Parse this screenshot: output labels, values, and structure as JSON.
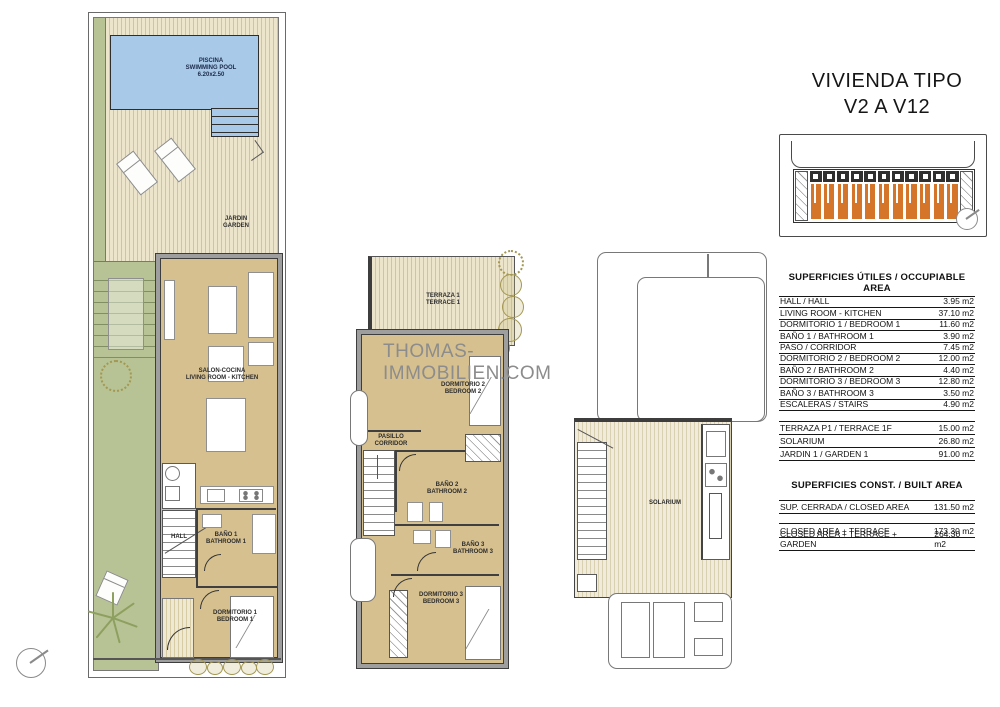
{
  "watermark": "THOMAS-IMMOBILIEN.COM",
  "title": {
    "line1": "VIVIENDA TIPO",
    "line2": "V2 A V12"
  },
  "plans": {
    "ground": {
      "pool_label": "PISCINA\nSWIMMING POOL\n6.20x2.50",
      "garden_label": "JARDIN\nGARDEN",
      "living_label": "SALON-COCINA\nLIVING ROOM - KITCHEN",
      "hall_label": "HALL",
      "bath1_label": "BAÑO 1\nBATHROOM 1",
      "bed1_label": "DORMITORIO 1\nBEDROOM 1"
    },
    "first": {
      "terrace_label": "TERRAZA 1\nTERRACE 1",
      "bed2_label": "DORMITORIO 2\nBEDROOM 2",
      "corridor_label": "PASILLO\nCORRIDOR",
      "bath2_label": "BAÑO 2\nBATHROOM 2",
      "bath3_label": "BAÑO 3\nBATHROOM 3",
      "bed3_label": "DORMITORIO 3\nBEDROOM 3"
    },
    "solarium": {
      "solarium_label": "SOLARIUM"
    }
  },
  "tables": {
    "occupiable": {
      "header": "SUPERFICIES ÚTILES / OCCUPIABLE AREA",
      "rows": [
        {
          "label": "HALL / HALL",
          "value": "3.95 m2"
        },
        {
          "label": "LIVING ROOM - KITCHEN",
          "value": "37.10 m2"
        },
        {
          "label": "DORMITORIO 1 /  BEDROOM 1",
          "value": "11.60 m2"
        },
        {
          "label": "BAÑO 1 / BATHROOM 1",
          "value": "3.90 m2"
        },
        {
          "label": "PASO / CORRIDOR",
          "value": "7.45 m2"
        },
        {
          "label": "DORMITORIO 2 / BEDROOM 2",
          "value": "12.00 m2"
        },
        {
          "label": "BAÑO 2 / BATHROOM 2",
          "value": "4.40 m2"
        },
        {
          "label": "DORMITORIO 3 / BEDROOM 3",
          "value": "12.80 m2"
        },
        {
          "label": "BAÑO 3 / BATHROOM 3",
          "value": "3.50 m2"
        },
        {
          "label": "ESCALERAS / STAIRS",
          "value": "4.90 m2"
        }
      ],
      "rows2": [
        {
          "label": "TERRAZA P1 / TERRACE 1F",
          "value": "15.00 m2"
        },
        {
          "label": "SOLARIUM",
          "value": "26.80 m2"
        },
        {
          "label": "JARDIN 1 / GARDEN 1",
          "value": "91.00 m2"
        }
      ]
    },
    "built": {
      "header": "SUPERFICIES  CONST. / BUILT AREA",
      "rows": [
        {
          "label": "SUP. CERRADA / CLOSED AREA",
          "value": "131.50 m2"
        }
      ],
      "rows2": [
        {
          "label": "CLOSED AREA + TERRACE",
          "value": "173.30 m2"
        },
        {
          "label": "CLOSED AREA + TERRACE + GARDEN",
          "value": "264.30 m2"
        }
      ]
    }
  },
  "colors": {
    "pool_blue": "#a9c9e9",
    "garden_green": "#b7c394",
    "deck_beige": "#ece4cb",
    "room_tan": "#d6c08f",
    "wall_gray": "#9e9e9e",
    "unit_orange": "#d4752a",
    "watermark_gray": "#8c8c8c"
  }
}
